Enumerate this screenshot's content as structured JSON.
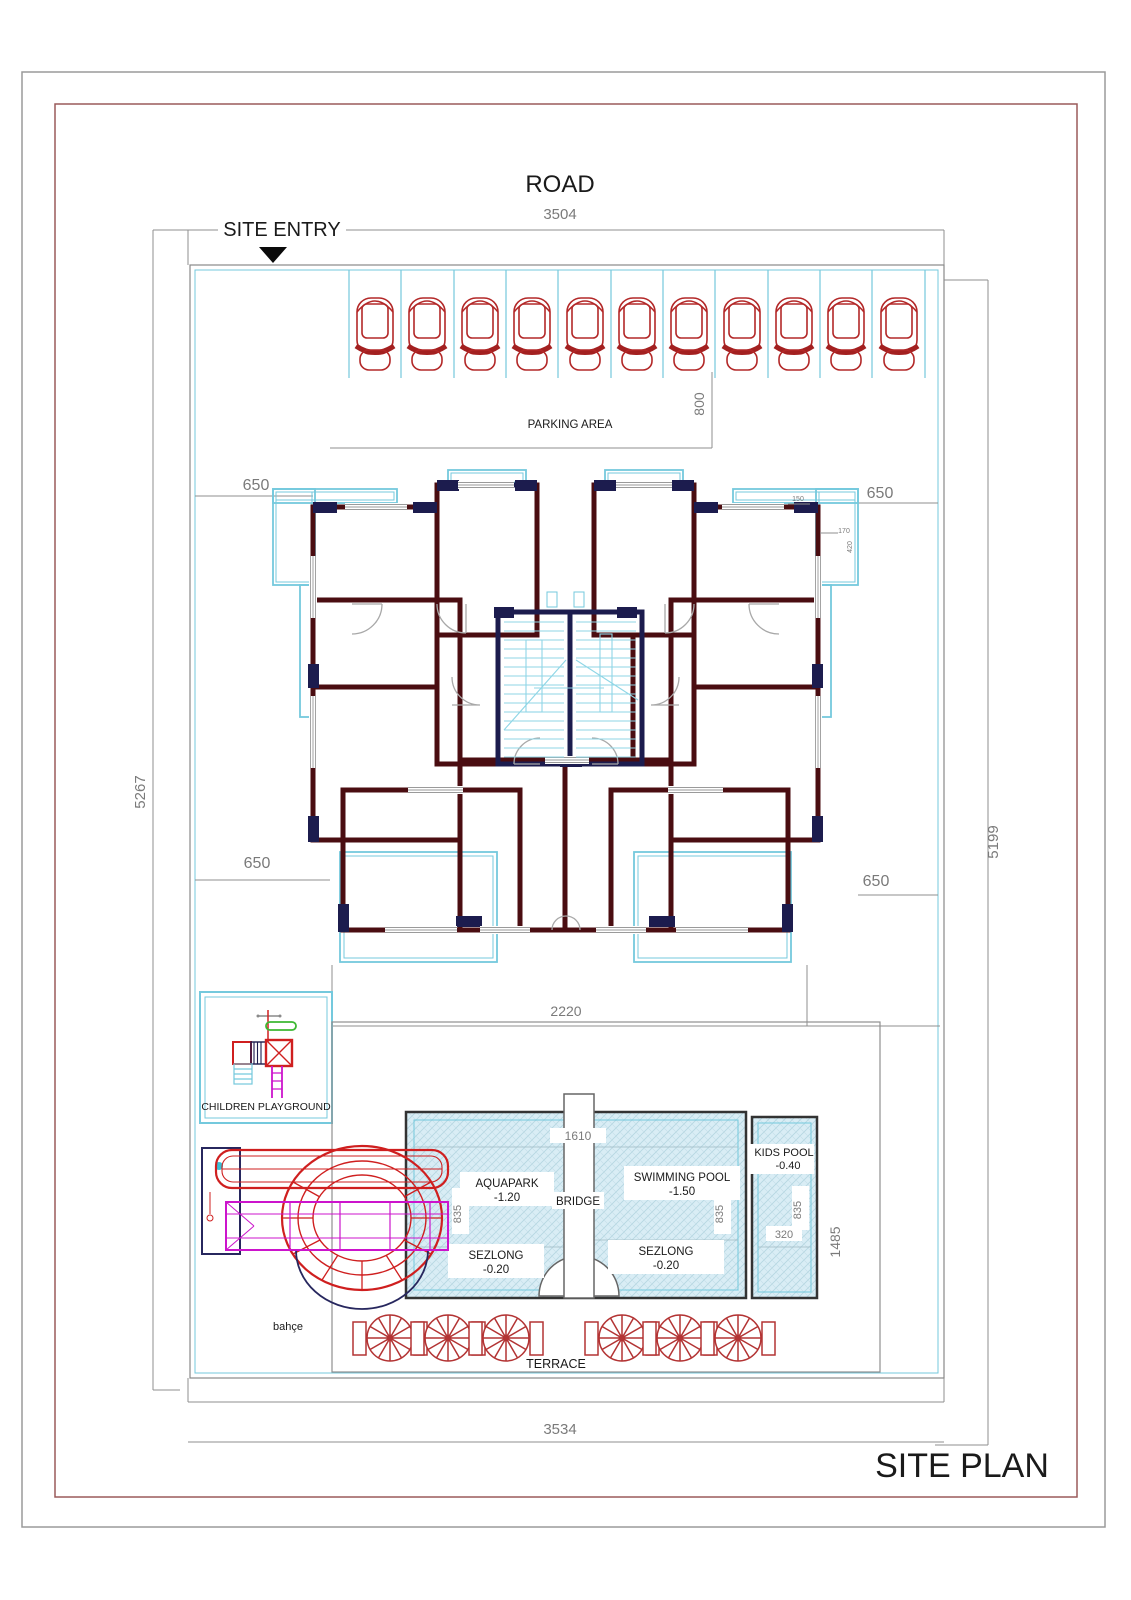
{
  "drawing": {
    "title": "SITE PLAN",
    "road_label": "ROAD",
    "site_entry_label": "SITE ENTRY"
  },
  "parking": {
    "label": "PARKING AREA",
    "car_count": 11,
    "depth_dim": "800"
  },
  "site_dimensions": {
    "top_width": "3504",
    "bottom_width": "3534",
    "left_height": "5267",
    "right_height": "5199"
  },
  "setbacks": {
    "top_left": "650",
    "top_right": "650",
    "bottom_left": "650",
    "bottom_right": "650"
  },
  "building": {
    "width_dim": "2220",
    "balcony_dims": {
      "a": "150",
      "b": "170",
      "c": "420"
    }
  },
  "playground": {
    "label": "CHILDREN PLAYGROUND"
  },
  "pool_area": {
    "bridge": {
      "label": "BRIDGE",
      "length_dim": "1610"
    },
    "aquapark": {
      "label": "AQUAPARK",
      "level": "-1.20",
      "width_dim": "835"
    },
    "swimming_pool": {
      "label": "SWIMMING POOL",
      "level": "-1.50",
      "width_dim": "835"
    },
    "kids_pool": {
      "label": "KIDS POOL",
      "level": "-0.40",
      "width_dim": "835",
      "inner_dim": "320"
    },
    "sezlong_left": {
      "label": "SEZLONG",
      "level": "-0.20"
    },
    "sezlong_right": {
      "label": "SEZLONG",
      "level": "-0.20"
    },
    "height_dim": "1485"
  },
  "terrace": {
    "label": "TERRACE",
    "umbrella_count": 6
  },
  "garden": {
    "label": "bahçe"
  },
  "colors": {
    "wall": "#4a0d11",
    "column": "#1c1c4e",
    "balcony": "#74c9dd",
    "stairs": "#8fd6e6",
    "car": "#b32828",
    "slide_red": "#cf1f1f",
    "slide_magenta": "#cc14cc",
    "playground_green": "#3cb832",
    "pool_fill": "#d9edf5",
    "dimension_gray": "#7a7a7a",
    "frame_outer": "#9a9a9a",
    "frame_inner": "#9a5a5a"
  }
}
